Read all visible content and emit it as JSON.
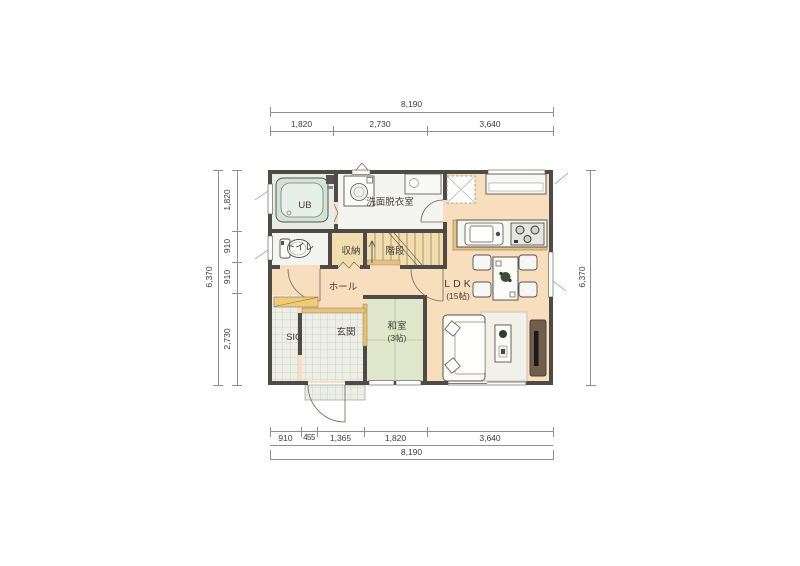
{
  "rooms": {
    "ub": "UB",
    "washroom": "洗面脱衣室",
    "toilet": "トイレ",
    "storage": "収納",
    "stairs": "階段",
    "hall": "ホール",
    "ldk": "LDK",
    "ldk_size": "(15帖)",
    "entrance": "玄関",
    "sic": "SIC",
    "washitsu": "和室",
    "washitsu_size": "(3帖)"
  },
  "dimensions": {
    "top": {
      "total": "8,190",
      "segments": [
        "1,820",
        "2,730",
        "3,640"
      ]
    },
    "bottom": {
      "total": "8,190",
      "segments": [
        "910",
        "455",
        "1,365",
        "1,820",
        "3,640"
      ]
    },
    "left": {
      "total": "6,370",
      "segments": [
        "1,820",
        "910",
        "910",
        "2,730"
      ]
    },
    "right": {
      "total": "6,370"
    }
  },
  "colors": {
    "wood_floor": "#f7dfbd",
    "wet_floor": "#f4f5f1",
    "tatami": "#e0e7cd",
    "tile": "#edefe7",
    "bath": "#cfe4d4",
    "wall": "#4e4a46",
    "wood_trim": "#e9c27c",
    "tv_board": "#6f5f4c"
  }
}
